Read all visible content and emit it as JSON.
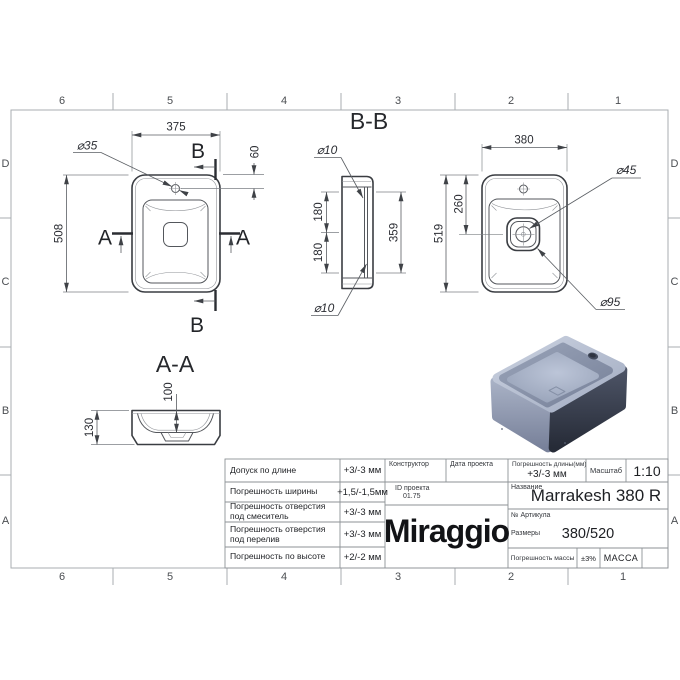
{
  "frame": {
    "zone_numbers": [
      "6",
      "5",
      "4",
      "3",
      "2",
      "1"
    ],
    "zone_letters": [
      "D",
      "C",
      "B",
      "A"
    ]
  },
  "views": {
    "plan": {
      "dim_width": "375",
      "dim_height": "508",
      "dim_hole_offset": "60",
      "label_hole_dia": "⌀35",
      "label_section_b_top": "B",
      "label_section_b_bottom": "B",
      "label_section_a_left": "A",
      "label_section_a_right": "A"
    },
    "section_bb": {
      "title": "B-B",
      "label_hole_dia_top": "⌀10",
      "label_hole_dia_bottom": "⌀10",
      "dim_hole_spacing_top": "180",
      "dim_hole_spacing_bottom": "180",
      "dim_inner_length": "359"
    },
    "bottom_view": {
      "dim_width": "380",
      "dim_height": "519",
      "dim_drain_offset": "260",
      "label_drain_dia": "⌀45",
      "label_drain_outer_dia": "⌀95"
    },
    "section_aa": {
      "title": "A-A",
      "dim_basin_depth": "100",
      "dim_total_height": "130"
    }
  },
  "title_block": {
    "tolerances": [
      {
        "name": "Допуск по длине",
        "value": "+3/-3 мм"
      },
      {
        "name": "Погрешность ширины",
        "value": "+1,5/-1,5мм"
      },
      {
        "name": "Погрешность отверстия под смеситель",
        "value": "+3/-3 мм"
      },
      {
        "name": "Погрешность отверстия под перелив",
        "value": "+3/-3 мм"
      },
      {
        "name": "Погрешность по высоте",
        "value": "+2/-2 мм"
      }
    ],
    "constructor_label": "Конструктор",
    "project_date_label": "Дата проекта",
    "project_id_label": "ID проекта",
    "project_id_value": "01.75",
    "logo": "Miraggio",
    "length_tolerance_label": "Погрешность длины(мм)",
    "length_tolerance_value": "+3/-3 мм",
    "scale_label": "Масштаб",
    "scale_value": "1:10",
    "name_label": "Название",
    "name_value": "Marrakesh 380 R",
    "article_label": "№ Артикула",
    "dimensions_label": "Размеры",
    "dimensions_value": "380/520",
    "mass_tolerance_label": "Погрешность массы",
    "mass_tolerance_value": "±3%",
    "mass_label": "МАССА"
  }
}
